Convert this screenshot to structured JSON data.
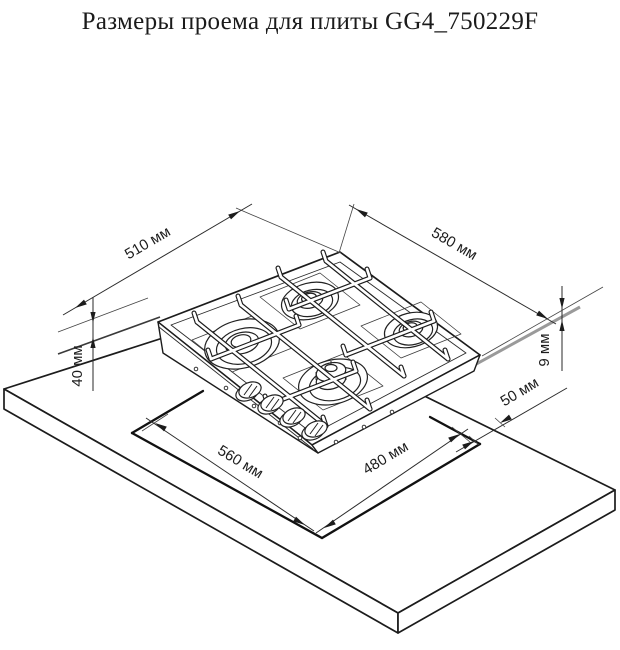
{
  "title": "Размеры проема для плиты GG4_750229F",
  "model": "GG4_750229F",
  "unit": "мм",
  "diagram_type": "isometric cutout installation drawing of 4-burner gas hob on worktop",
  "dimensions": {
    "hob_depth": {
      "label": "510 мм",
      "value": 510,
      "measures": "hob depth (left top edge)"
    },
    "hob_width": {
      "label": "580 мм",
      "value": 580,
      "measures": "hob width (right top edge)"
    },
    "body_drop": {
      "label": "40 мм",
      "value": 40,
      "measures": "vertical offset at left side"
    },
    "rim_height": {
      "label": "9 мм",
      "value": 9,
      "measures": "panel rim height above worktop"
    },
    "right_clearance": {
      "label": "50 мм",
      "value": 50,
      "measures": "clearance at right of opening"
    },
    "cutout_width": {
      "label": "560 мм",
      "value": 560,
      "measures": "opening length (front-left edge)"
    },
    "cutout_depth": {
      "label": "480 мм",
      "value": 480,
      "measures": "opening depth (front-right edge)"
    }
  },
  "colors": {
    "background": "#ffffff",
    "line": "#1c1c1c",
    "seal_strip_gray": "#9a9a9a"
  }
}
